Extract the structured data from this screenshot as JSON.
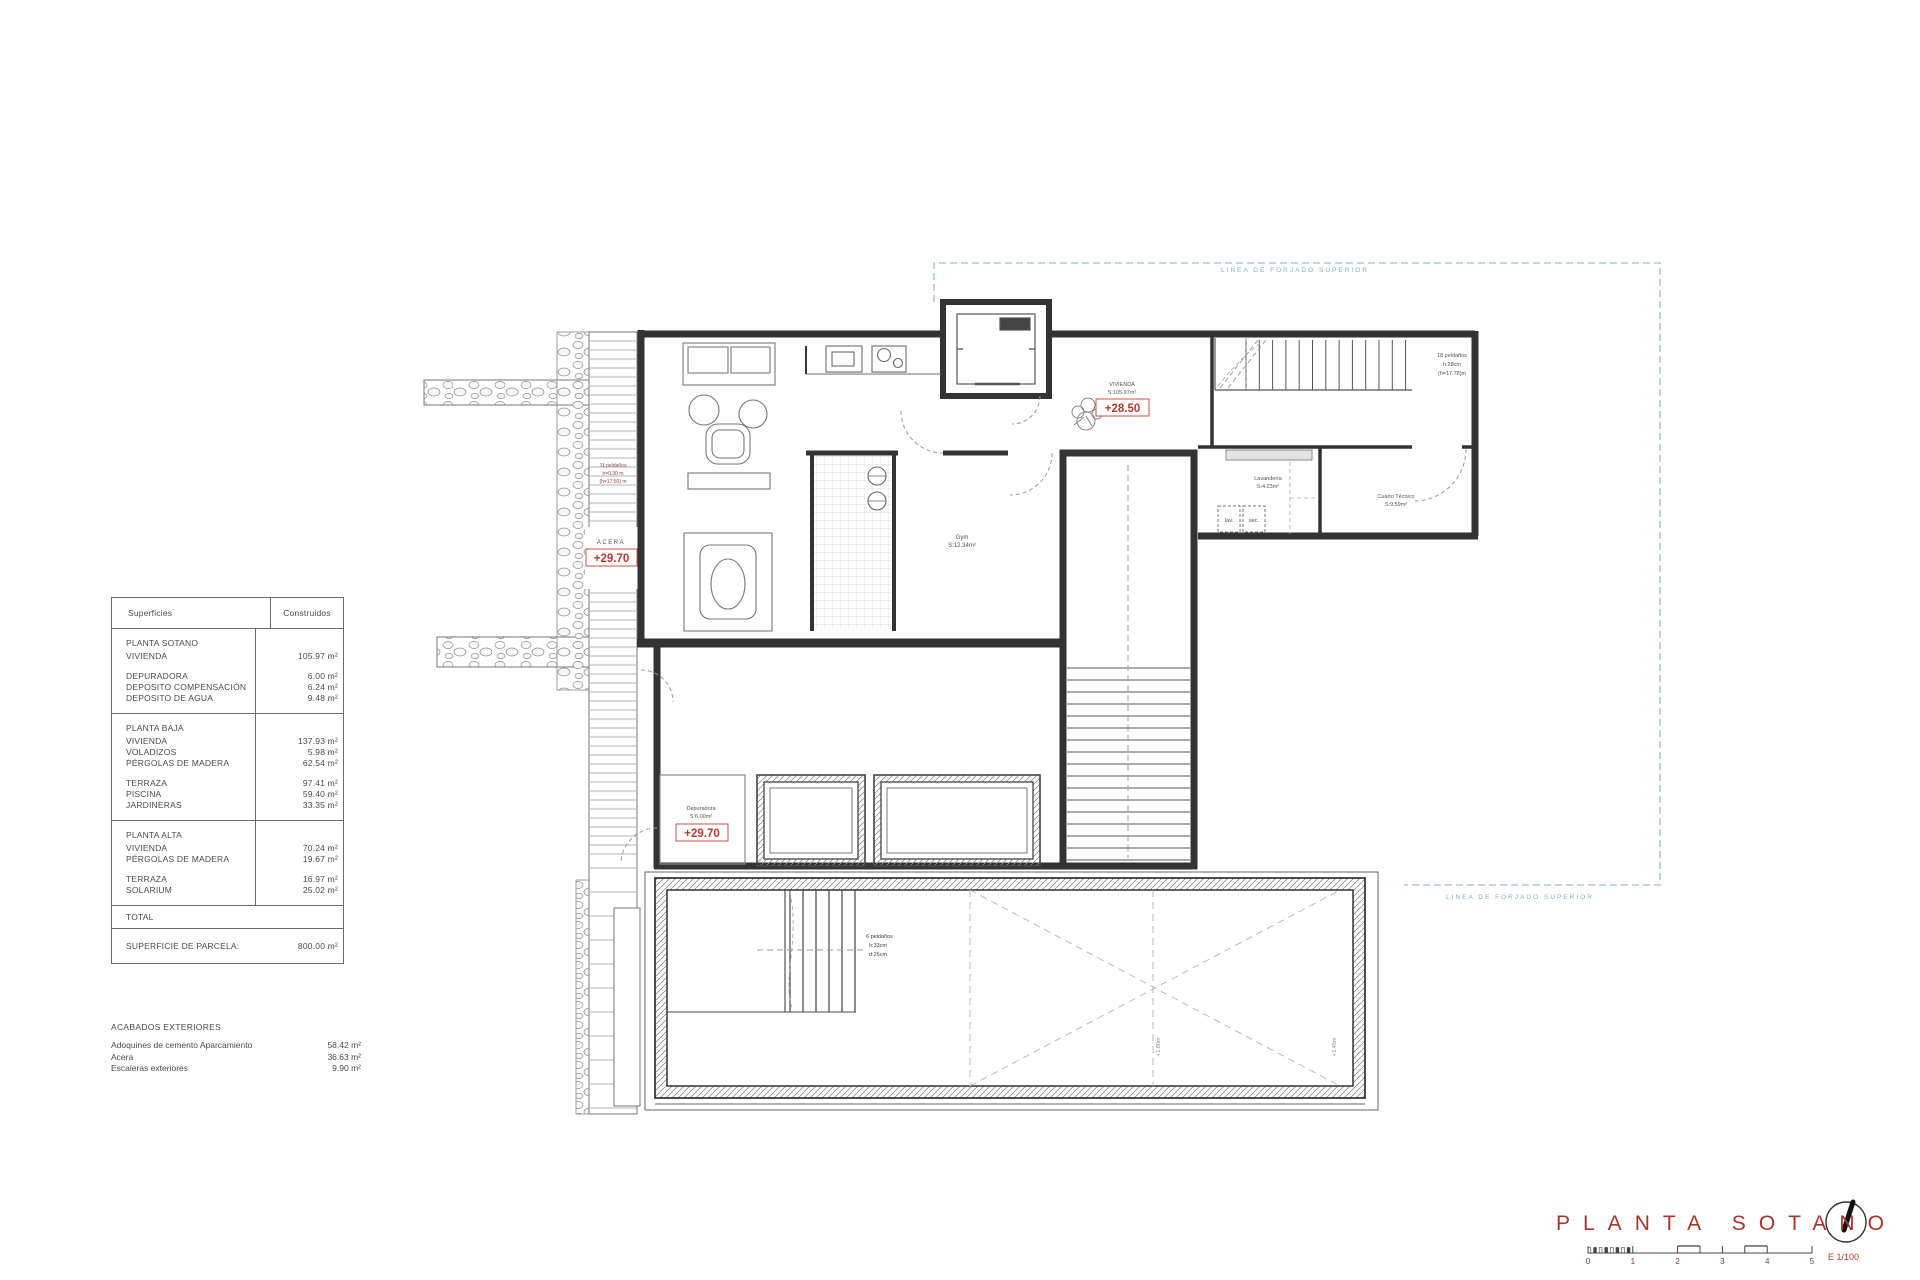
{
  "meta": {
    "sheet_title": "PLANTA SOTANO",
    "scale_label": "E 1/100",
    "scale_ticks": [
      "0",
      "1",
      "2",
      "3",
      "4",
      "5"
    ]
  },
  "surfaces_table": {
    "headers": [
      "Superficies",
      "Construidos"
    ],
    "sections": [
      {
        "title": "PLANTA SOTANO",
        "groups": [
          [
            [
              "VIVIENDA",
              "105.97 m²"
            ]
          ],
          [
            [
              "DEPURADORA",
              "6.00 m²"
            ],
            [
              "DEPOSITO COMPENSACIÓN",
              "6.24 m²"
            ],
            [
              "DEPOSITO DE AGUA",
              "9.48 m²"
            ]
          ]
        ]
      },
      {
        "title": "PLANTA BAJA",
        "groups": [
          [
            [
              "VIVIENDA",
              "137.93 m²"
            ],
            [
              "VOLADIZOS",
              "5.98 m²"
            ],
            [
              "PÉRGOLAS DE MADERA",
              "62.54 m²"
            ]
          ],
          [
            [
              "TERRAZA",
              "97.41 m²"
            ],
            [
              "PISCINA",
              "59.40 m²"
            ],
            [
              "JARDINERAS",
              "33.35 m²"
            ]
          ]
        ]
      },
      {
        "title": "PLANTA ALTA",
        "groups": [
          [
            [
              "VIVIENDA",
              "70.24 m²"
            ],
            [
              "PÉRGOLAS DE MADERA",
              "19.67 m²"
            ]
          ],
          [
            [
              "TERRAZA",
              "16.97 m²"
            ],
            [
              "SOLARIUM",
              "25.02 m²"
            ]
          ]
        ]
      }
    ],
    "total_label": "TOTAL",
    "parcel_label": "SUPERFICIE DE PARCELA:",
    "parcel_value": "800.00 m²"
  },
  "acabados": {
    "title": "ACABADOS EXTERIORES",
    "rows": [
      [
        "Adoquines de cemento Aparcamiento",
        "58.42 m²"
      ],
      [
        "Acera",
        "36.63 m²"
      ],
      [
        "Escaleras exteriores",
        "9.90 m²"
      ]
    ]
  },
  "plan": {
    "forjado_label_top": "LINEA DE FORJADO SUPERIOR",
    "forjado_label_bottom": "LINEA DE FORJADO SUPERIOR",
    "level_top": {
      "room": "VIVIENDA",
      "area": "S:105.97m²",
      "level": "+28.50"
    },
    "acera": {
      "label": "ACERA",
      "level": "+29.70"
    },
    "depuradora": {
      "room": "Depuradora",
      "area": "S:6.00m²",
      "level": "+29.70"
    },
    "gym": {
      "room": "Gym",
      "area": "S:12.34m²"
    },
    "lavanderia": {
      "room": "Lavandería",
      "area": "S:4.23m²"
    },
    "cuarto_tecnico": {
      "room": "Cuarto Técnico",
      "area": "S:9.59m²"
    },
    "appliances": {
      "washer": "lav.",
      "dryer": "sec."
    },
    "stair_note_right": [
      "18 peldaños",
      "h:28cm",
      "(h=17.78)m"
    ],
    "stair_note_acera": [
      "11 peldaños",
      "h=0.30 m",
      "(h=17.50) m"
    ],
    "stair_note_garage": [
      "6 peldaños",
      "h:33cm",
      "d:26cm"
    ],
    "garage_marks": [
      "+1.90m",
      "+1.45m"
    ]
  },
  "colors": {
    "accent_red": "#b13a30",
    "forjado_blue": "#7fb2bf",
    "wall": "#333333"
  }
}
